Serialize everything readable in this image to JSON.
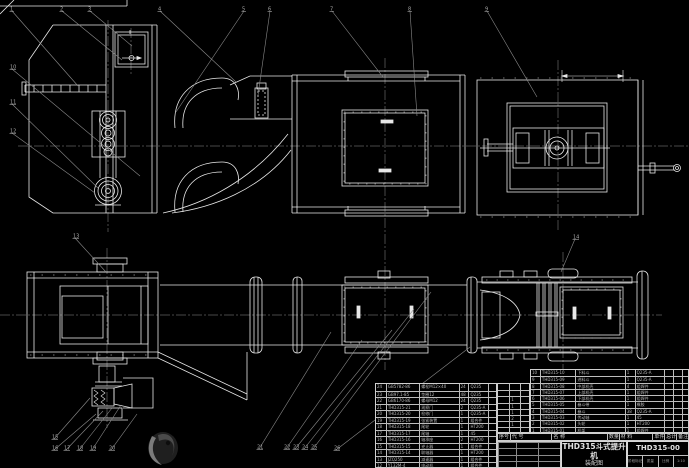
{
  "drawing": {
    "bg_color": "#000000",
    "line_color": "#e8e8e8",
    "muted_color": "#8f8f8f",
    "views": [
      "side-elevation",
      "plan-view"
    ]
  },
  "title_block": {
    "product": "THD315斗式提升机",
    "doc_type": "装配图",
    "drawing_number": "THD315-00",
    "footer_cells": [
      "阶段标记",
      "质量",
      "比例"
    ],
    "scale": "1:10"
  },
  "bom": {
    "headers": [
      "序号",
      "代 号",
      "名 称",
      "数量",
      "材 料",
      "单件",
      "总计",
      "备注"
    ],
    "right_rows": [
      [
        "10",
        "THD315-10",
        "下料斗",
        "1",
        "Q235-A",
        "",
        "",
        ""
      ],
      [
        "9",
        "THD315-09",
        "进料斗",
        "1",
        "Q235-A",
        "",
        "",
        ""
      ],
      [
        "8",
        "THD315-08",
        "中部机壳",
        "4",
        "组焊件",
        "",
        "",
        ""
      ],
      [
        "7",
        "THD315-07",
        "上部机壳",
        "1",
        "组焊件",
        "",
        "",
        ""
      ],
      [
        "6",
        "THD315-06",
        "下部机壳",
        "1",
        "组焊件",
        "",
        "",
        ""
      ],
      [
        "5",
        "THD315-05",
        "畚斗带",
        "1",
        "橡胶",
        "",
        "",
        ""
      ],
      [
        "4",
        "THD315-04",
        "畚斗",
        "38",
        "Q235-A",
        "",
        "",
        ""
      ],
      [
        "3",
        "THD315-03",
        "传动轴",
        "1",
        "45",
        "",
        "",
        ""
      ],
      [
        "2",
        "THD315-02",
        "头轮",
        "1",
        "HT200",
        "",
        "",
        ""
      ],
      [
        "1",
        "THD315-01",
        "机架",
        "1",
        "组焊件",
        "",
        "",
        ""
      ]
    ],
    "left_rows": [
      [
        "24",
        "GB5782-86",
        "螺栓M12×40",
        "24",
        "Q235",
        ""
      ],
      [
        "23",
        "GB97.1-85",
        "垫圈12",
        "48",
        "Q235",
        ""
      ],
      [
        "22",
        "GB6170-86",
        "螺母M12",
        "24",
        "Q235",
        ""
      ],
      [
        "21",
        "THD315-21",
        "观察门",
        "2",
        "Q235-A",
        ""
      ],
      [
        "20",
        "THD315-20",
        "检修门",
        "1",
        "Q235-A",
        ""
      ],
      [
        "19",
        "THD315-19",
        "张紧装置",
        "1",
        "组合件",
        ""
      ],
      [
        "18",
        "THD315-18",
        "尾轮",
        "1",
        "HT200",
        ""
      ],
      [
        "17",
        "THD315-17",
        "尾轴",
        "1",
        "45",
        ""
      ],
      [
        "16",
        "THD315-16",
        "轴承座",
        "2",
        "HT200",
        ""
      ],
      [
        "15",
        "THD315-15",
        "逆止器",
        "1",
        "组合件",
        ""
      ],
      [
        "14",
        "THD315-14",
        "联轴器",
        "1",
        "HT200",
        ""
      ],
      [
        "13",
        "JZQ250",
        "减速器",
        "1",
        "组合件",
        ""
      ],
      [
        "12",
        "Y132M-4",
        "电动机",
        "1",
        "组合件",
        ""
      ]
    ],
    "ext_rows": [
      [
        "",
        "",
        ""
      ],
      [
        "",
        "",
        ""
      ],
      [
        "",
        "1",
        ""
      ],
      [
        "",
        "1",
        ""
      ],
      [
        "",
        "1",
        ""
      ],
      [
        "",
        "2",
        ""
      ],
      [
        "",
        "1",
        ""
      ],
      [
        "",
        "",
        ""
      ]
    ]
  },
  "balloons": [
    {
      "label": "1",
      "x": 10,
      "y": 8,
      "tx": 78,
      "ty": 86
    },
    {
      "label": "2",
      "x": 60,
      "y": 8,
      "tx": 122,
      "ty": 60
    },
    {
      "label": "3",
      "x": 88,
      "y": 8,
      "tx": 132,
      "ty": 46
    },
    {
      "label": "4",
      "x": 158,
      "y": 8,
      "tx": 236,
      "ty": 82
    },
    {
      "label": "5",
      "x": 242,
      "y": 8,
      "tx": 176,
      "ty": 112
    },
    {
      "label": "6",
      "x": 268,
      "y": 8,
      "tx": 258,
      "ty": 95
    },
    {
      "label": "7",
      "x": 330,
      "y": 8,
      "tx": 383,
      "ty": 77
    },
    {
      "label": "8",
      "x": 408,
      "y": 8,
      "tx": 417,
      "ty": 116
    },
    {
      "label": "9",
      "x": 485,
      "y": 8,
      "tx": 537,
      "ty": 97
    },
    {
      "label": "10",
      "x": 10,
      "y": 66,
      "tx": 140,
      "ty": 176
    },
    {
      "label": "11",
      "x": 10,
      "y": 101,
      "tx": 98,
      "ty": 188
    },
    {
      "label": "12",
      "x": 10,
      "y": 130,
      "tx": 95,
      "ty": 193
    },
    {
      "label": "13",
      "x": 73,
      "y": 235,
      "tx": 106,
      "ty": 272
    },
    {
      "label": "14",
      "x": 573,
      "y": 236,
      "tx": 561,
      "ty": 272
    },
    {
      "label": "15",
      "x": 52,
      "y": 436,
      "tx": 90,
      "ty": 398
    },
    {
      "label": "16",
      "x": 52,
      "y": 447,
      "tx": 96,
      "ty": 414
    },
    {
      "label": "17",
      "x": 64,
      "y": 447,
      "tx": 103,
      "ty": 411
    },
    {
      "label": "18",
      "x": 77,
      "y": 447,
      "tx": 112,
      "ty": 408
    },
    {
      "label": "19",
      "x": 90,
      "y": 447,
      "tx": 121,
      "ty": 405
    },
    {
      "label": "20",
      "x": 109,
      "y": 447,
      "tx": 137,
      "ty": 414
    },
    {
      "label": "21",
      "x": 257,
      "y": 446,
      "tx": 331,
      "ty": 332
    },
    {
      "label": "22",
      "x": 284,
      "y": 446,
      "tx": 362,
      "ty": 340
    },
    {
      "label": "23",
      "x": 293,
      "y": 446,
      "tx": 392,
      "ty": 330
    },
    {
      "label": "24",
      "x": 302,
      "y": 446,
      "tx": 414,
      "ty": 309
    },
    {
      "label": "25",
      "x": 311,
      "y": 446,
      "tx": 431,
      "ty": 292
    },
    {
      "label": "26",
      "x": 334,
      "y": 447,
      "tx": 470,
      "ty": 347
    }
  ]
}
